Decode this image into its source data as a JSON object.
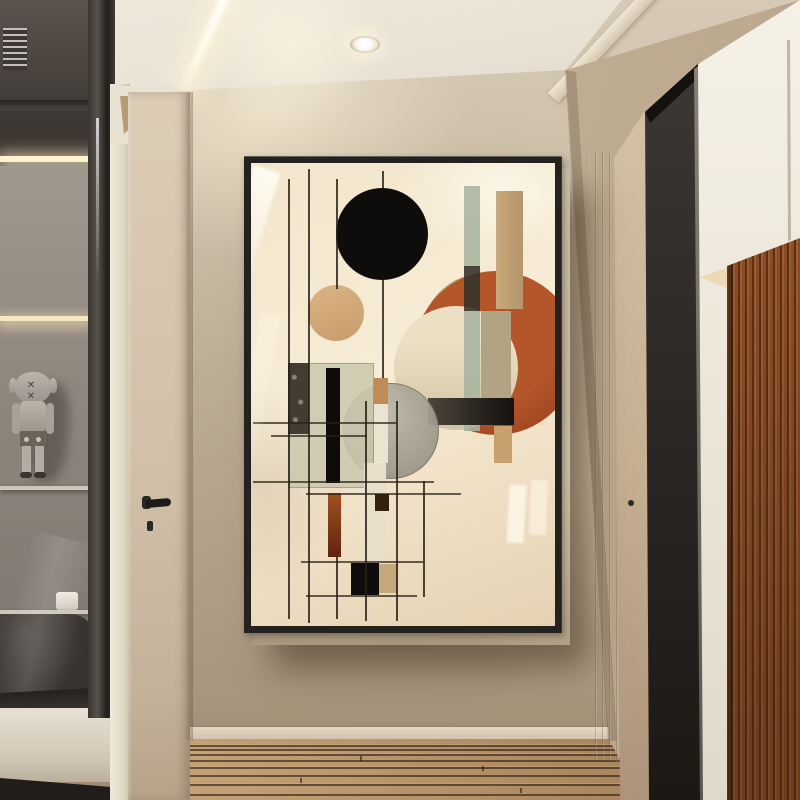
{
  "meta": {
    "image_type": "interior-photograph",
    "subject": "hallway with framed abstract geometric wall art"
  },
  "colors": {
    "wall": "#c9bba4",
    "wall-dark": "#a4947d",
    "ceiling": "#eae3d6",
    "frame": "#23221f",
    "art-bg": "#f4e7cd",
    "art-black": "#0f0d0b",
    "art-orange": "#b4552a",
    "art-rust": "#9c4a1e",
    "art-tan": "#d0a878",
    "art-tan2": "#bb9b6d",
    "art-sage": "#a9b4a0",
    "art-olive": "#cbc8ad",
    "art-khaki": "#b2a483",
    "door": "#d7c7b0",
    "trim": "#f0e9da",
    "doorway-dark": "#292624",
    "white-panel": "#f2eee4",
    "wood": "#8a4e27",
    "floor": "#8f6b4a",
    "led": "#fff3cf"
  },
  "scene": {
    "ceiling": {
      "lights": [
        "linear-led-streak",
        "recessed-downlight"
      ],
      "soffit": "diagonal-beam"
    },
    "left": {
      "display_cabinet": {
        "shelves": 4,
        "items": [
          "toy-figure",
          "white-cup",
          "dark-bench"
        ],
        "lighting": "led-shelf-strips",
        "vent": true
      },
      "door": {
        "hardware": [
          "lever-handle",
          "keyhole"
        ]
      },
      "toy_eyes": "✕ ✕"
    },
    "wall_art": {
      "frame": "thin-black-float-frame",
      "style": "mid-century-abstract-geometric",
      "shapes": [
        "black-circle",
        "tan-circle",
        "orange-circle",
        "cream-circle",
        "tan-arc",
        "sage-stripe",
        "tan-stripe",
        "charcoal-bar",
        "olive-panel",
        "rust-bar",
        "black-squares",
        "pendant-lines",
        "grid-lines"
      ],
      "glass_glare": [
        "diagonal-streak-upper-left",
        "window-reflections-lower-right"
      ]
    },
    "right": {
      "beige_door_frame": true,
      "open_dark_doorway": true,
      "white_side_panel": true,
      "wood_slat_cabinet": true
    },
    "floor": {
      "material": "wood-planks",
      "orientation": "horizontal"
    }
  }
}
